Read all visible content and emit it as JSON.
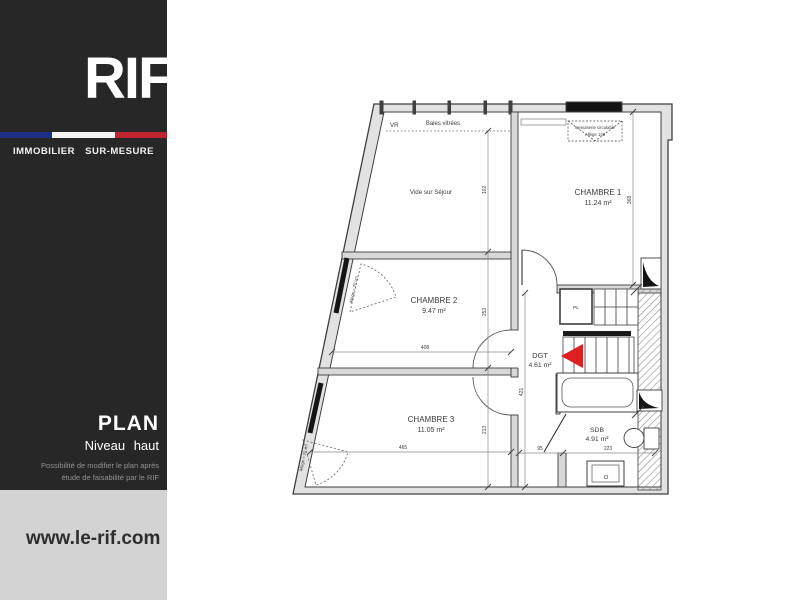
{
  "brand": {
    "logo_text": "RIF",
    "tagline": "IMMOBILIER SUR-MESURE",
    "website": "www.le-rif.com"
  },
  "panel": {
    "title": "PLAN",
    "subtitle": "Niveau haut",
    "note_line1": "Possibilité de modifier le plan après",
    "note_line2": "étude de faisabilité par le RIF"
  },
  "plan": {
    "rooms": [
      {
        "name": "CHAMBRE 1",
        "area": "11.24 m²"
      },
      {
        "name": "CHAMBRE 2",
        "area": "9.47 m²"
      },
      {
        "name": "CHAMBRE 3",
        "area": "11.05 m²"
      },
      {
        "name": "DGT",
        "area": "4.61 m²"
      },
      {
        "name": "SDB",
        "area": "4.91 m²"
      }
    ],
    "labels": {
      "void_over_living": "Vide sur Séjour",
      "glazing": "Baies vitrées",
      "vr": "VR",
      "closet": "PL",
      "window_note_line1": "menuiserie circulable",
      "window_note_line2": "Allège 140",
      "sill_height": "Allège = 20 cm"
    },
    "dimensions": {
      "void_height": "102",
      "chambre1_height": "368",
      "chambre2_height": "253",
      "chambre3_height": "213",
      "dgt_height": "421",
      "chambre2_width": "408",
      "chambre3_width": "465",
      "sdb_left_width": "95",
      "sdb_width": "223"
    },
    "colors": {
      "arrow_red": "#df1f1f"
    }
  }
}
